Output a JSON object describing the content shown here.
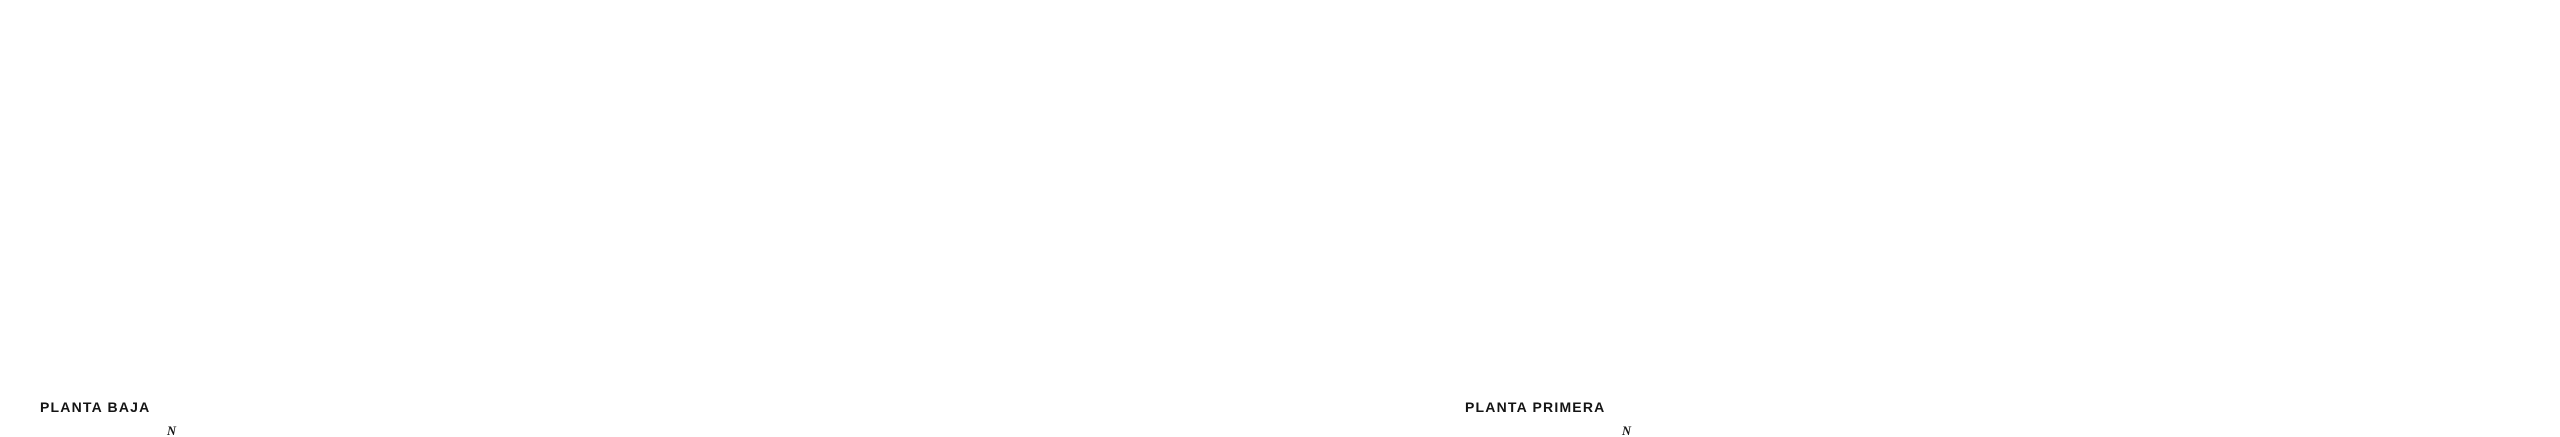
{
  "page": {
    "background": "#ffffff",
    "drawing_ink": "#3a3a3a",
    "wall_ink": "#5f5f5f",
    "ghost_ink": "#c9c9c9",
    "marker_ink": "#141414"
  },
  "plans": [
    {
      "id": "planta-baja",
      "label": "PLANTA BAJA",
      "compass_letter": "N"
    },
    {
      "id": "planta-primera",
      "label": "PLANTA PRIMERA",
      "compass_letter": "N"
    }
  ]
}
